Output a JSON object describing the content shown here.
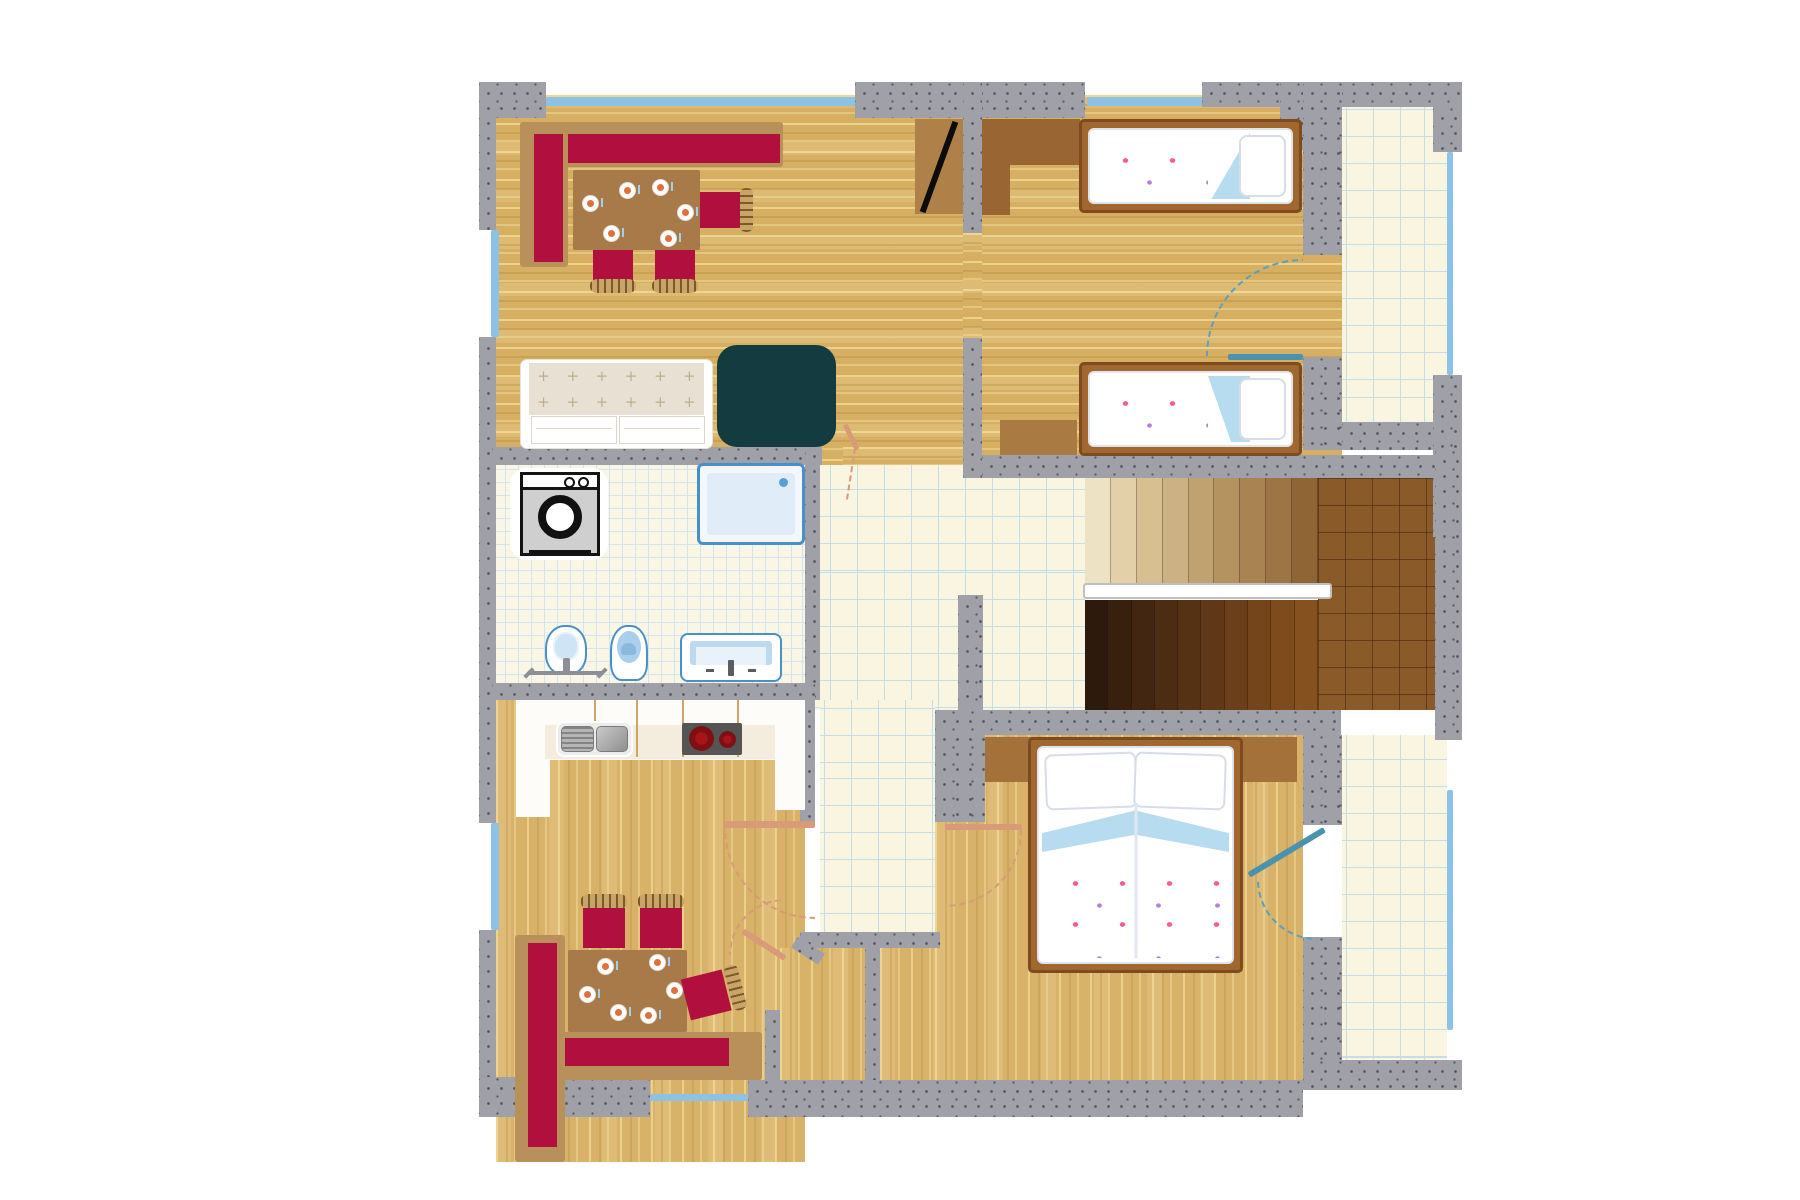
{
  "meta": {
    "title": "Apartment floor plan",
    "view": "top-down architectural drawing",
    "visible_text": "none"
  },
  "palette": {
    "wall_gray": "#9fa0a8",
    "wall_speckle": "#55555f",
    "wood_floor": "#d6af63",
    "wood_streak_light": "#ecd9a0",
    "wood_streak_dark": "#bb9245",
    "tile_floor": "#faf5e1",
    "tile_line": "#c4dee9",
    "upholstery_crimson": "#b10f3e",
    "bench_wood": "#b9905a",
    "table_wood": "#a87a4a",
    "coffee_table_teal": "#143c40",
    "wardrobe_brown": "#996633",
    "bed_frame": "#a0672f",
    "bed_frame_border": "#7d4b1e",
    "linen_white": "#ffffff",
    "blanket_fold_blue": "#b8dcef",
    "flower_pink": "#ef5f95",
    "flower_purple": "#b87fd4",
    "sanitary_outline_blue": "#4a90c8",
    "sanitary_fill": "#cfe4f4",
    "window_glazing": "#8ec2e4",
    "door_swing_salmon": "#d89a78",
    "balcony_door_teal": "#4a93ad",
    "stair_landing_brown": "#8a5a28",
    "burner_red": "#8e1116"
  },
  "stairs": {
    "upper_steps": [
      "#eee2c4",
      "#e3d0a8",
      "#d7bf92",
      "#cbb183",
      "#c0a271",
      "#b49361",
      "#a98452",
      "#9d7544",
      "#8f6536"
    ],
    "lower_steps": [
      "#2e1a0d",
      "#38200f",
      "#422611",
      "#4c2c13",
      "#563215",
      "#603817",
      "#6a3f19",
      "#74451b",
      "#7e4b1d",
      "#84511f"
    ]
  },
  "tables": {
    "living": {
      "plates": [
        [
          17,
          33
        ],
        [
          54,
          20
        ],
        [
          87,
          17
        ],
        [
          112,
          42
        ],
        [
          38,
          63
        ],
        [
          95,
          68
        ]
      ]
    },
    "kitchen": {
      "plates": [
        [
          37,
          16
        ],
        [
          89,
          12
        ],
        [
          106,
          40
        ],
        [
          19,
          44
        ],
        [
          50,
          62
        ],
        [
          80,
          65
        ]
      ]
    }
  },
  "sofa": {
    "tuft_rows": 2,
    "tuft_cols": 6,
    "tuft_char": "+"
  },
  "furniture_icons": [
    "corner-bench",
    "dining-table",
    "place-setting",
    "dining-chair",
    "sofa",
    "coffee-table",
    "tv-panel",
    "single-bed",
    "double-bed",
    "pillow",
    "wardrobe",
    "dresser",
    "washing-machine",
    "shower-tray",
    "bidet",
    "toilet",
    "washbasin",
    "kitchen-sink",
    "cooktop",
    "staircase",
    "handrail",
    "door-swing",
    "balcony-door",
    "window"
  ]
}
